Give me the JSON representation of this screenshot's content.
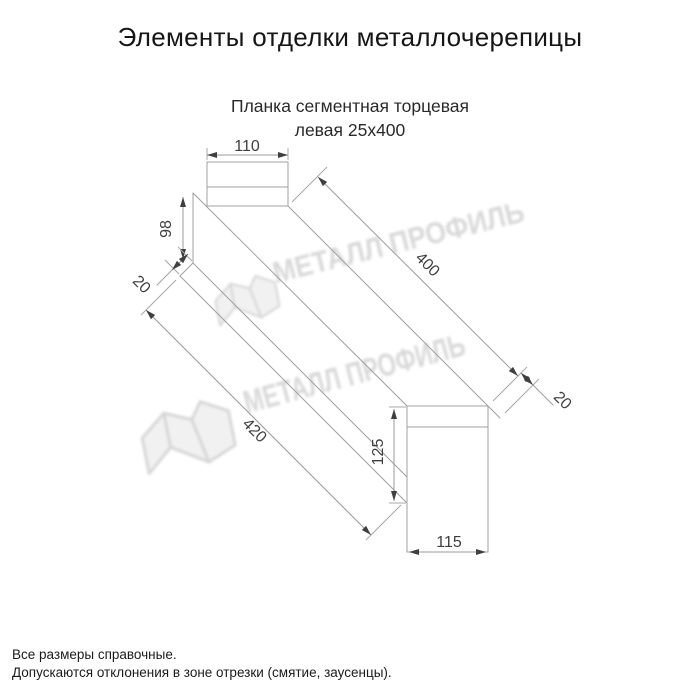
{
  "title": "Элементы отделки металлочерепицы",
  "subtitle": {
    "line1": "Планка сегментная торцевая",
    "line2": "левая 25х400"
  },
  "watermark": {
    "brand": "МЕТАЛЛ ПРОФИЛЬ",
    "icon": "metal-profile-logo"
  },
  "dimensions": {
    "top_width": "110",
    "left_height": "98",
    "left_flap": "20",
    "top_length": "400",
    "bottom_length": "420",
    "right_flap": "20",
    "right_height": "125",
    "bottom_width": "115"
  },
  "notes": [
    "Все размеры справочные.",
    "Допускаются отклонения в зоне отрезки (смятие, заусенцы)."
  ],
  "colors": {
    "line": "#a0a0a0",
    "dim_text": "#3f3f3f",
    "watermark": "#d2d2d2",
    "background": "#ffffff"
  }
}
